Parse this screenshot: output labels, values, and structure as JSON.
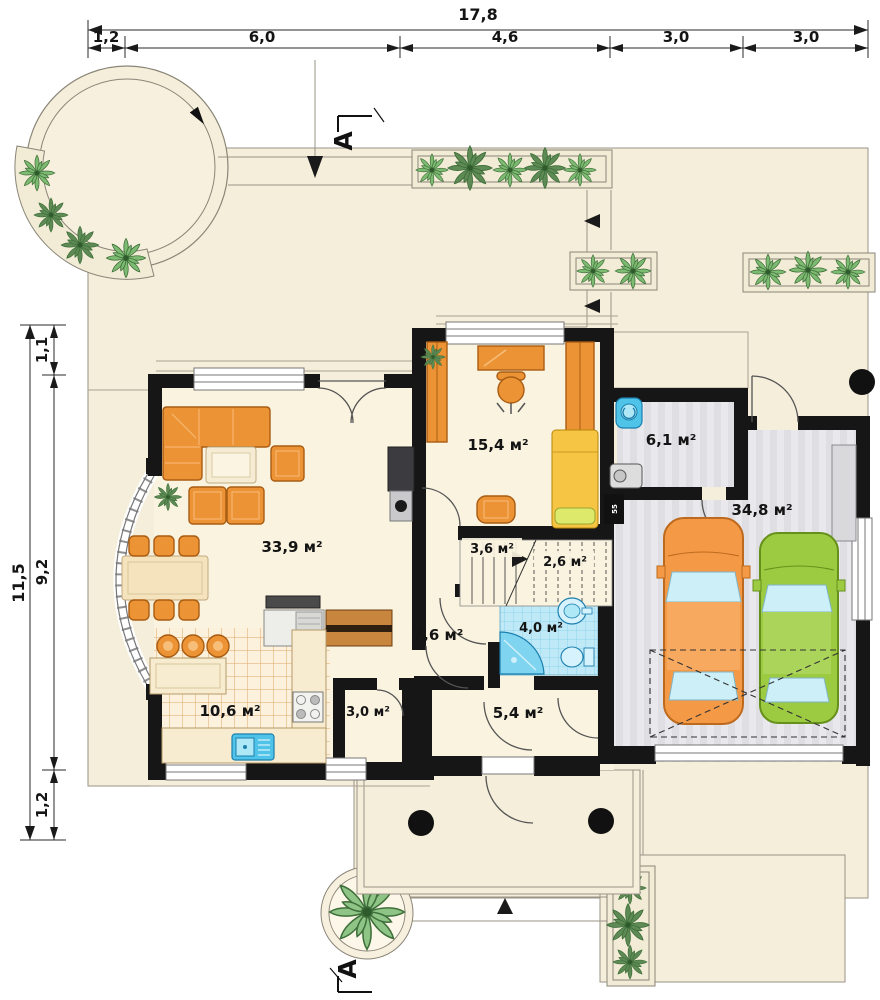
{
  "plan": {
    "dimensions": {
      "top": {
        "total": "17,8",
        "segments": [
          "1,2",
          "6,0",
          "4,6",
          "3,0",
          "3,0"
        ]
      },
      "left": {
        "total": "11,5",
        "segments": [
          "1,1",
          "9,2",
          "1,2"
        ]
      }
    },
    "section": {
      "top": "A",
      "bottom": "A"
    },
    "rooms": {
      "living": {
        "area": "33,9 м²"
      },
      "office": {
        "area": "15,4 м²"
      },
      "utility": {
        "area": "6,1 м²"
      },
      "garage": {
        "area": "34,8 м²"
      },
      "stairs_lower": {
        "area": "3,6 м²"
      },
      "stairs_upper": {
        "area": "2,6 м²"
      },
      "hall": {
        "area": "7,6 м²"
      },
      "bathroom": {
        "area": "4,0 м²"
      },
      "entry": {
        "area": "5,4 м²"
      },
      "kitchen": {
        "area": "10,6 м²"
      },
      "pantry": {
        "area": "3,0 м²"
      }
    },
    "annotations": {
      "radiator_tag": "55"
    },
    "colors": {
      "wall": "#161616",
      "lot": "#F5EEDA",
      "floor": "#FAF3E0",
      "furniture_orange": "#EC9336",
      "bed_yellow": "#F6C544",
      "sanitary_blue": "#4FC4E8",
      "bath_tile": "#BFE9F7",
      "garage_floor": "#E9E9ED",
      "car_left": "#F49A47",
      "car_right": "#9CCB42",
      "plant_green": "#7DBB72"
    }
  }
}
